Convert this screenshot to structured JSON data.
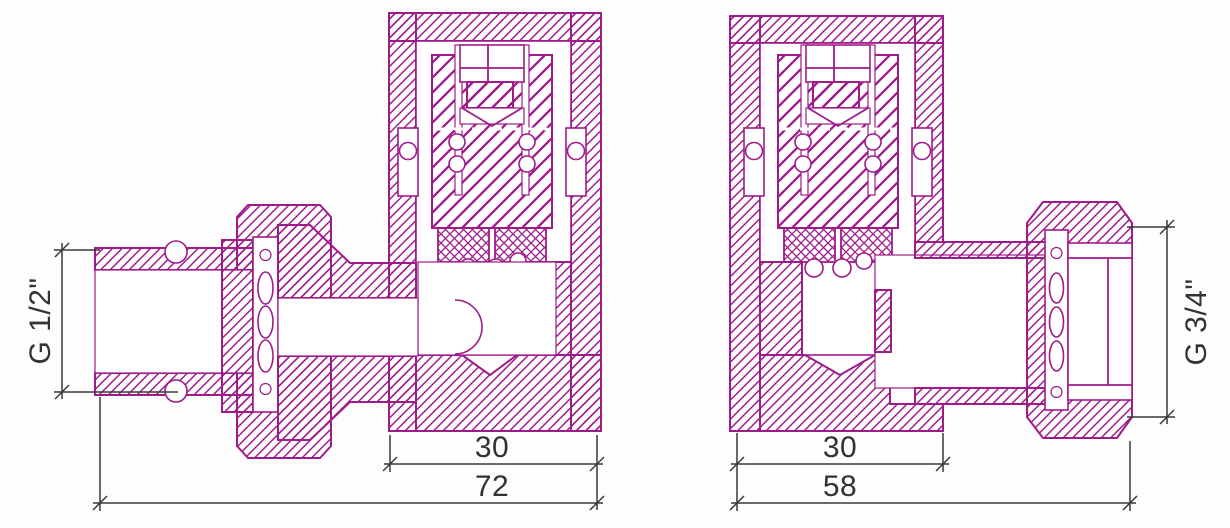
{
  "title": "angle-valve-technical-drawing",
  "colors": {
    "line": "#9e1b8a",
    "dimension": "#3a3a3a",
    "background": "#fdfdfd"
  },
  "figures": [
    {
      "id": "left-valve",
      "description": "angle valve cross-section, union connection on left",
      "thread_label": "G 1/2\"",
      "body_width": "30",
      "overall_width": "72"
    },
    {
      "id": "right-valve",
      "description": "angle valve cross-section, union connection on right",
      "thread_label": "G 3/4\"",
      "body_width": "30",
      "overall_width": "58"
    }
  ]
}
